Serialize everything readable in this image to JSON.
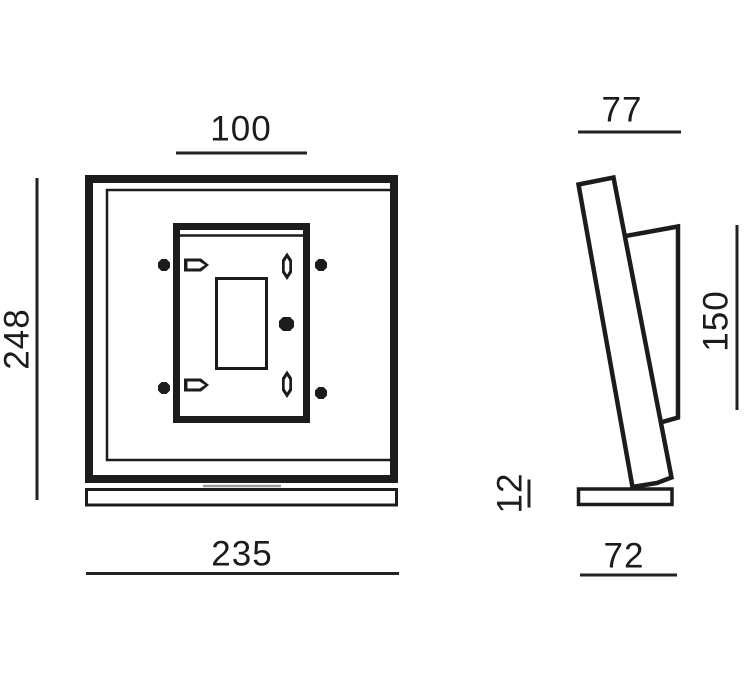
{
  "figure": {
    "background": "#ffffff",
    "line_color": "#1c1c1c",
    "dim_color": "#222222",
    "hidden_line_color": "#9a9a9a",
    "dimensions": {
      "plate_width": "100",
      "overall_height": "248",
      "overall_width": "235",
      "depth_top": "77",
      "bracket_height": "150",
      "base_thickness": "12",
      "base_depth": "72"
    }
  }
}
